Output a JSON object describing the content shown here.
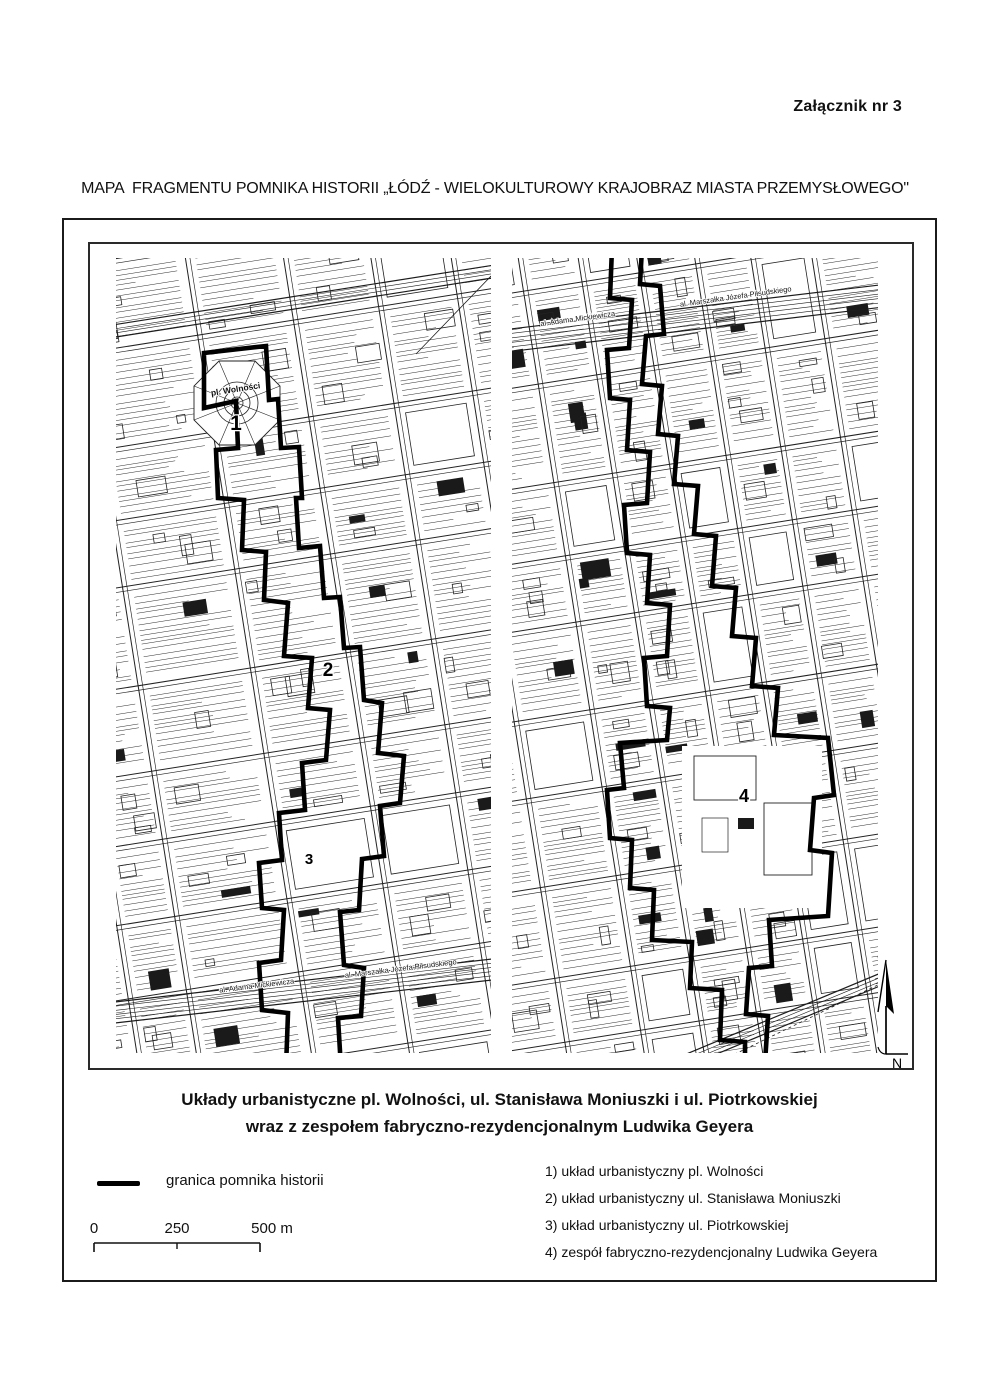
{
  "page": {
    "attachment_label": "Załącznik nr 3",
    "title": "MAPA  FRAGMENTU POMNIKA HISTORII „ŁÓDŹ - WIELOKULTUROWY KRAJOBRAZ MIASTA PRZEMYSŁOWEGO\""
  },
  "map": {
    "caption_line1": "Układy urbanistyczne pl. Wolności, ul. Stanisława Moniuszki i ul. Piotrkowskiej",
    "caption_line2": "wraz z zespołem fabryczno-rezydencjonalnym Ludwika Geyera",
    "labels": {
      "plaza": "pl. Wolności",
      "num1": "1",
      "num2": "2",
      "num3": "3",
      "num4": "4",
      "street_mickiewicza": "al. Adama Mickiewicza",
      "street_pilsudskiego": "al. Marszałka Józefa Piłsudskiego",
      "north": "N"
    }
  },
  "legend": {
    "boundary_label": "granica pomnika historii",
    "scale": {
      "t0": "0",
      "t250": "250",
      "t500": "500 m"
    }
  },
  "list": {
    "items": [
      "1) układ urbanistyczny pl. Wolności",
      "2) układ urbanistyczny ul. Stanisława Moniuszki",
      "3) układ urbanistyczny ul. Piotrkowskiej",
      "4) zespół fabryczno-rezydencjonalny Ludwika Geyera"
    ]
  },
  "colors": {
    "ink": "#111111",
    "map_line": "#222222",
    "boundary": "#000000",
    "paper": "#ffffff"
  }
}
